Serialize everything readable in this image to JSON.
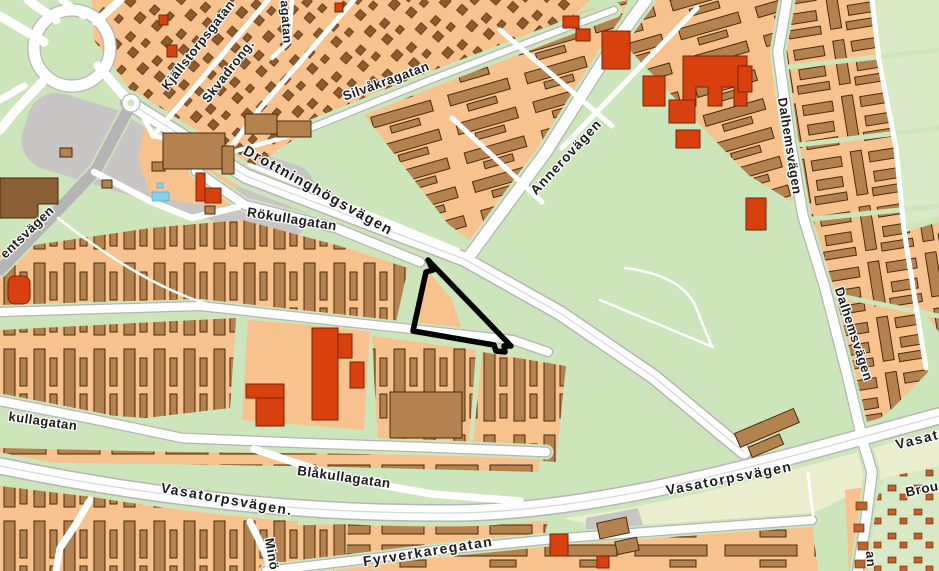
{
  "page_title": "Map",
  "map": {
    "description": "street-map-with-highlighted-parcel",
    "palette": {
      "green": "#cde5bb",
      "green_light": "#d9e9c6",
      "field": "#eaeecd",
      "block": "#f7c28e",
      "building": "#b3824f",
      "building_dark": "#8a5f35",
      "building_stroke": "#4a2a0e",
      "house": "#8f5a2c",
      "red_building": "#d8400e",
      "red_stroke": "#7a2404",
      "gray_area": "#c7c6c4",
      "road": "#ffffff",
      "road_casing": "#b5b5b5",
      "road_centerline": "#d9d9d9",
      "water": "#82d2f0",
      "allot_dot": "#c2622a",
      "label": "#1d1d1d",
      "highlight": "#000000"
    },
    "highlight": {
      "name": "highlighted-parcel-outline",
      "points": "428,260 433,270 426,272 413,331 494,345 496,351 505,352 504,346 511,346",
      "stroke_width": 5.5
    },
    "labels": [
      {
        "name": "street-label-kjallstorpsgatan",
        "text": "Kjällstorpsgatan",
        "x": 198,
        "y": 45,
        "rot": -52,
        "size": 13,
        "ls": 0.5
      },
      {
        "name": "street-label-skvadrong",
        "text": "Skvadrong.",
        "x": 228,
        "y": 71,
        "rot": -52,
        "size": 13,
        "ls": 0.5
      },
      {
        "name": "street-label-agatan-fragment",
        "text": "agatan",
        "x": 286,
        "y": 22,
        "rot": 86,
        "size": 12.5,
        "ls": 0.5
      },
      {
        "name": "street-label-silvakragatan",
        "text": "Silvåkragatan",
        "x": 386,
        "y": 81,
        "rot": -20,
        "size": 13,
        "ls": 0.5
      },
      {
        "name": "street-label-drottninghogsvagen",
        "text": "Drottninghögsvägen",
        "x": 318,
        "y": 191,
        "rot": 29,
        "size": 14.5,
        "ls": 1.5
      },
      {
        "name": "street-label-annerovagen",
        "text": "Annerovägen",
        "x": 566,
        "y": 157,
        "rot": -47,
        "size": 13.5,
        "ls": 1
      },
      {
        "name": "street-label-rokullagatan",
        "text": "Rökullagatan",
        "x": 292,
        "y": 219,
        "rot": 9,
        "size": 13.5,
        "ls": 0.5
      },
      {
        "name": "street-label-dalhemsvagen-north",
        "text": "Dalhemsvägen",
        "x": 790,
        "y": 146,
        "rot": 81,
        "size": 13,
        "ls": 0.5
      },
      {
        "name": "street-label-dalhemsvagen-south",
        "text": "Dalhemsvägen",
        "x": 854,
        "y": 334,
        "rot": 72,
        "size": 13,
        "ls": 0.5
      },
      {
        "name": "street-label-entsvagen-fragment",
        "text": "entsvägen",
        "x": 27,
        "y": 232,
        "rot": -44,
        "size": 13,
        "ls": 0.5
      },
      {
        "name": "street-label-kullagatan-fragment",
        "text": "kullagatan",
        "x": 43,
        "y": 421,
        "rot": 8,
        "size": 13,
        "ls": 0.5
      },
      {
        "name": "street-label-blakullagatan",
        "text": "Blåkullagatan",
        "x": 344,
        "y": 477,
        "rot": 8,
        "size": 13.5,
        "ls": 0.5
      },
      {
        "name": "street-label-vasatorpsvagen-west",
        "text": "Vasatorpsvägen.",
        "x": 227,
        "y": 499,
        "rot": 10,
        "size": 14,
        "ls": 1.5
      },
      {
        "name": "street-label-fyrverkaregatan",
        "text": "Fyrverkaregatan",
        "x": 428,
        "y": 551,
        "rot": -9,
        "size": 14,
        "ls": 1.5
      },
      {
        "name": "street-label-vasatorpsvagen-east",
        "text": "Vasatorpsvägen",
        "x": 729,
        "y": 478,
        "rot": -11,
        "size": 14,
        "ls": 1.5
      },
      {
        "name": "street-label-vasatorpsvagen-northeast",
        "text": "Vasatorpsvägen",
        "x": 958,
        "y": 429,
        "rot": -14,
        "size": 14,
        "ls": 1.5
      },
      {
        "name": "street-label-brou-fragment",
        "text": "Brou",
        "x": 922,
        "y": 489,
        "rot": -12,
        "size": 13.5,
        "ls": 0.5
      },
      {
        "name": "street-label-mino-fragment",
        "text": "Minö",
        "x": 272,
        "y": 554,
        "rot": 80,
        "size": 13,
        "ls": 0.5
      },
      {
        "name": "street-label-an-fragment",
        "text": "an",
        "x": 871,
        "y": 559,
        "rot": 86,
        "size": 13,
        "ls": 0.5
      }
    ]
  }
}
